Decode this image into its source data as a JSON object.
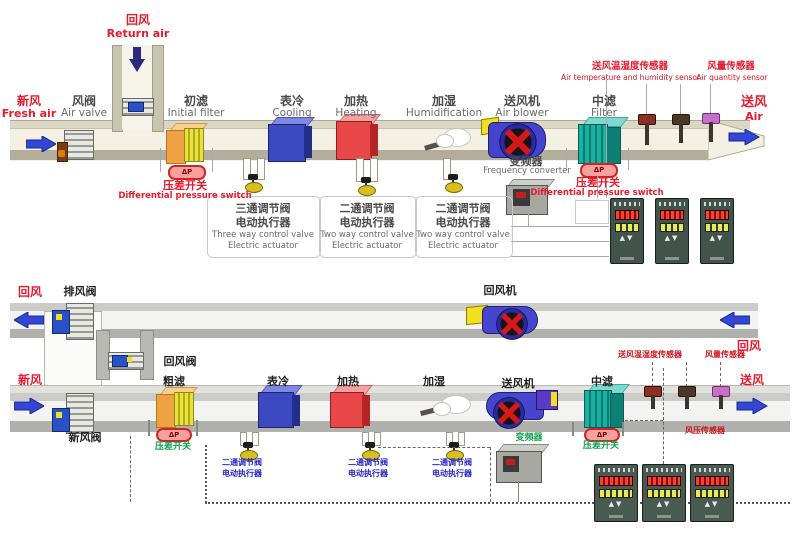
{
  "colors": {
    "accent_red": "#e8192d",
    "label_blue": "#2323cc",
    "label_green": "#12a050",
    "arrow_blue": "#3347d4",
    "cooling_blue": "#3c49c0",
    "heating_red": "#e84848",
    "filter_teal": "#18b2a2"
  },
  "top": {
    "return_air_zh": "回风",
    "return_air_en": "Return air",
    "fresh_air_zh": "新风",
    "fresh_air_en": "Fresh air",
    "air_valve_zh": "风阀",
    "air_valve_en": "Air valve",
    "initial_filter_zh": "初滤",
    "initial_filter_en": "Initial filter",
    "cooling_zh": "表冷",
    "cooling_en": "Cooling",
    "heating_zh": "加热",
    "heating_en": "Heating",
    "humidification_zh": "加湿",
    "humidification_en": "Humidification",
    "air_blower_zh": "送风机",
    "air_blower_en": "Air blower",
    "mid_filter_zh": "中滤",
    "mid_filter_en": "Filter",
    "supply_air_zh": "送风",
    "supply_air_en": "Air",
    "temp_humidity_sensor_zh": "送风温湿度传感器",
    "temp_humidity_sensor_en": "Air temperature and humidity sensor",
    "air_quantity_sensor_zh": "风量传感器",
    "air_quantity_sensor_en": "Air quantity sensor",
    "pressure_switch_zh": "压差开关",
    "pressure_switch_en": "Differential pressure switch",
    "frequency_converter_zh": "变频器",
    "frequency_converter_en": "Frequency converter",
    "three_way_zh1": "三通调节阀",
    "three_way_zh2": "电动执行器",
    "three_way_en1": "Three way control valve",
    "three_way_en2": "Electric actuator",
    "two_way_zh1": "二通调节阀",
    "two_way_zh2": "电动执行器",
    "two_way_en1": "Two way control valve",
    "two_way_en2": "Electric actuator",
    "dp": "ΔP"
  },
  "bottom": {
    "return_air": "回风",
    "exhaust_valve": "排风阀",
    "fresh_air": "新风",
    "fresh_air_valve": "新风阀",
    "return_valve": "回风阀",
    "coarse_filter": "粗滤",
    "cooling": "表冷",
    "heating": "加热",
    "humidification": "加湿",
    "supply_fan": "送风机",
    "mid_filter": "中滤",
    "return_fan": "回风机",
    "supply_air": "送风",
    "return_air_right": "回风",
    "temp_humidity_sensor": "送风温湿度传感器",
    "air_quantity_sensor": "风量传感器",
    "air_pressure_sensor": "风压传感器",
    "pressure_switch": "压差开关",
    "frequency_converter": "变频器",
    "two_way_zh1": "二通调节阀",
    "two_way_zh2": "电动执行器",
    "dp": "ΔP"
  }
}
